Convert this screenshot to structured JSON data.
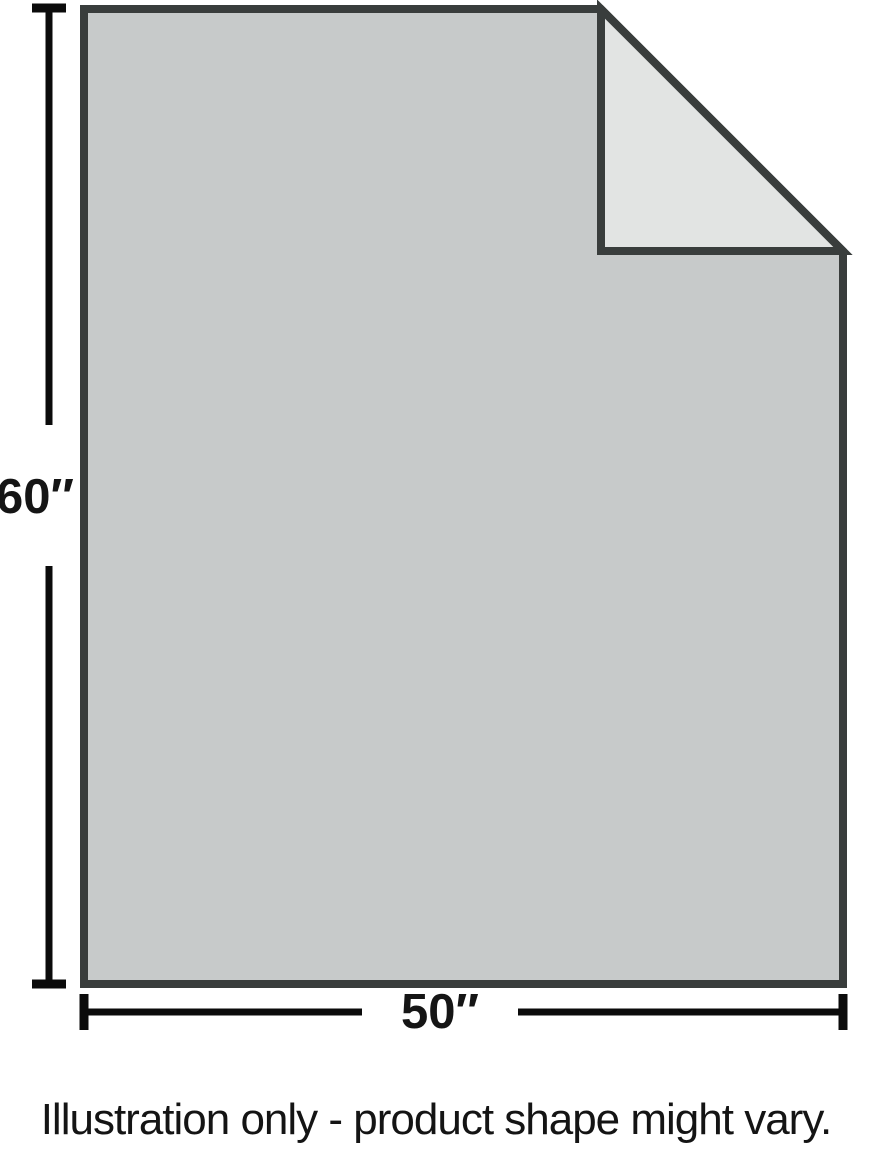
{
  "illustration": {
    "dimension_height": {
      "label": "60″"
    },
    "dimension_width": {
      "label": "50″"
    },
    "caption": "Illustration only - product shape might vary.",
    "colors": {
      "background": "#ffffff",
      "blanket_fill": "#c7caca",
      "fold_fill": "#e2e4e3",
      "outline": "#393d3c",
      "dimension_line": "#0b0b0b",
      "label_text": "#151515"
    }
  }
}
